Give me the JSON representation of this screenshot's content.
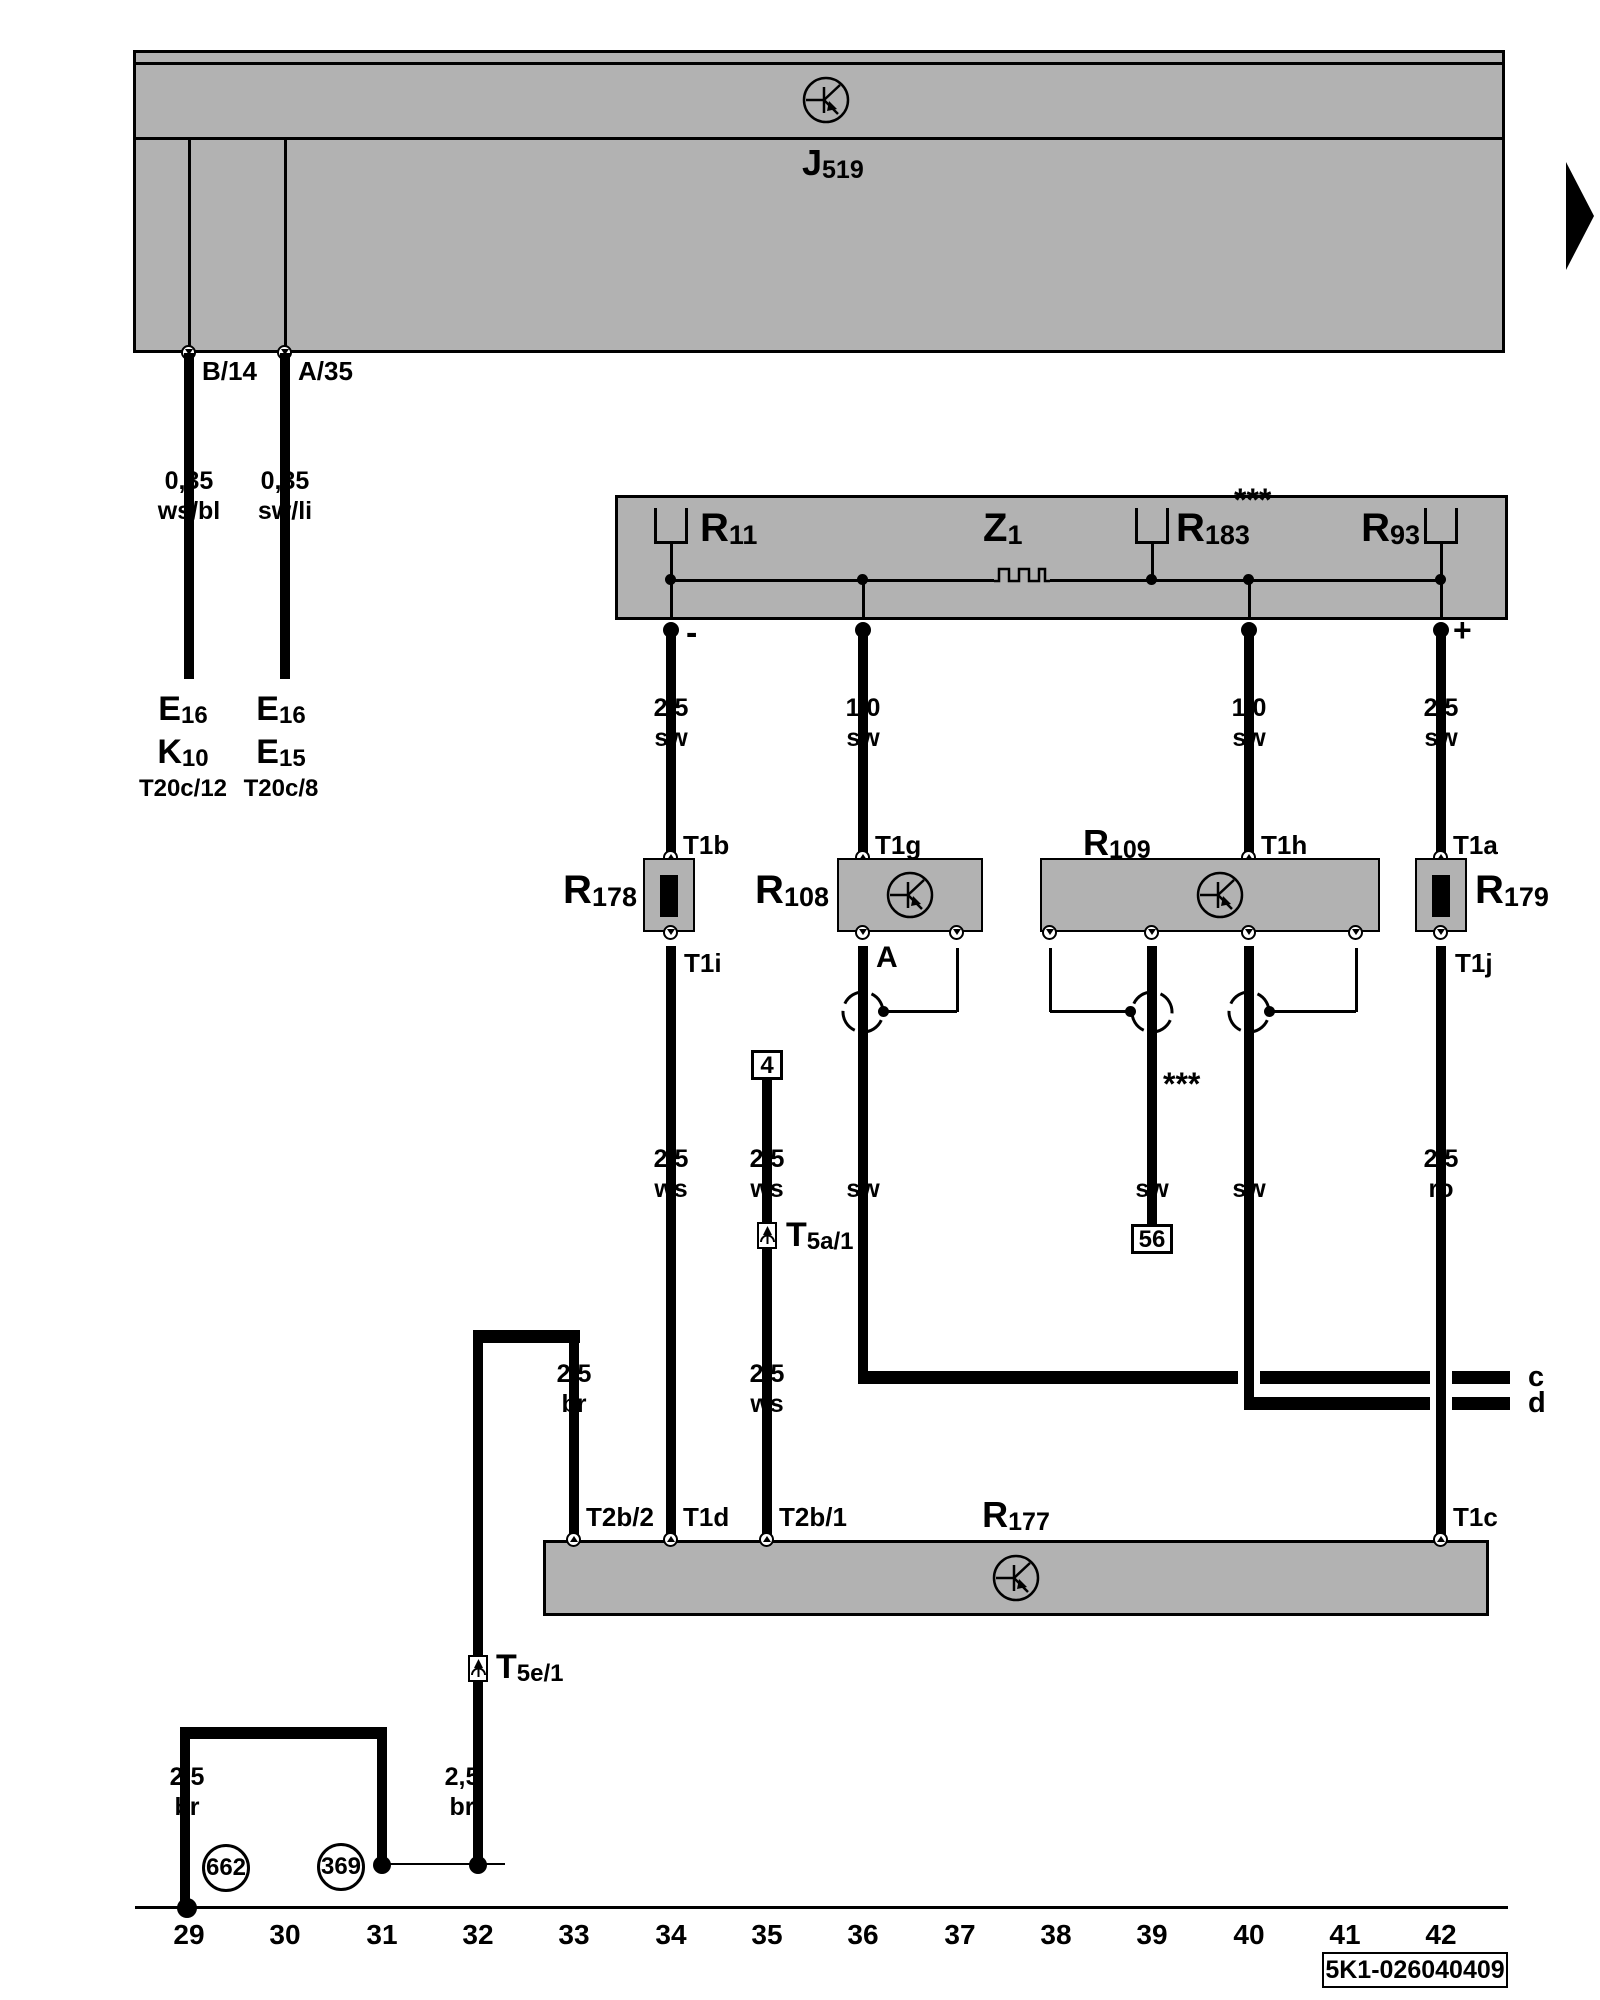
{
  "palette": {
    "gray": "#b2b2b2",
    "black": "#000000",
    "white": "#ffffff"
  },
  "control_unit": {
    "main": "J",
    "sub": "519",
    "terminal_left": "B/14",
    "terminal_right": "A/35"
  },
  "wire_labels": {
    "ws_bl": {
      "l1": "0,35",
      "l2": "ws/bl"
    },
    "sw_li": {
      "l1": "0,35",
      "l2": "sw/li"
    },
    "sw25": {
      "l1": "2,5",
      "l2": "sw"
    },
    "sw10": {
      "l1": "1,0",
      "l2": "sw"
    },
    "ws25": {
      "l1": "2,5",
      "l2": "ws"
    },
    "ro25": {
      "l1": "2,5",
      "l2": "ro"
    },
    "br25": {
      "l1": "2,5",
      "l2": "br"
    },
    "sw": "sw"
  },
  "targets": {
    "left": {
      "e_main": "E",
      "e_sub": "16",
      "k_main": "K",
      "k_sub": "10",
      "t": "T20c/12"
    },
    "right": {
      "e_main": "E",
      "e_sub": "16",
      "e2_main": "E",
      "e2_sub": "15",
      "t": "T20c/8"
    }
  },
  "relay_box": {
    "r11": {
      "main": "R",
      "sub": "11"
    },
    "z1": {
      "main": "Z",
      "sub": "1"
    },
    "r183": {
      "main": "R",
      "sub": "183"
    },
    "r93": {
      "main": "R",
      "sub": "93"
    },
    "stars": "***",
    "minus": "-",
    "plus": "+"
  },
  "components": {
    "r178": {
      "main": "R",
      "sub": "178"
    },
    "r108": {
      "main": "R",
      "sub": "108"
    },
    "r109": {
      "main": "R",
      "sub": "109"
    },
    "r179": {
      "main": "R",
      "sub": "179"
    },
    "r177": {
      "main": "R",
      "sub": "177"
    }
  },
  "connectors": {
    "t1a": "T1a",
    "t1b": "T1b",
    "t1c": "T1c",
    "t1d": "T1d",
    "t1g": "T1g",
    "t1h": "T1h",
    "t1i": "T1i",
    "t1j": "T1j",
    "t2b1": "T2b/1",
    "t2b2": "T2b/2",
    "a": "A"
  },
  "inline_connectors": {
    "t5a1": {
      "main": "T",
      "sub": "5a/1"
    },
    "t5e1": {
      "main": "T",
      "sub": "5e/1"
    }
  },
  "junction_boxes": {
    "four": "4",
    "fiftysix": "56"
  },
  "notes": {
    "stars": "***"
  },
  "ground_points": {
    "g662": "662",
    "g369": "369"
  },
  "page_refs": {
    "c": "c",
    "d": "d"
  },
  "track_numbers": [
    "29",
    "30",
    "31",
    "32",
    "33",
    "34",
    "35",
    "36",
    "37",
    "38",
    "39",
    "40",
    "41",
    "42"
  ],
  "diagram_code": "5K1-026040409"
}
